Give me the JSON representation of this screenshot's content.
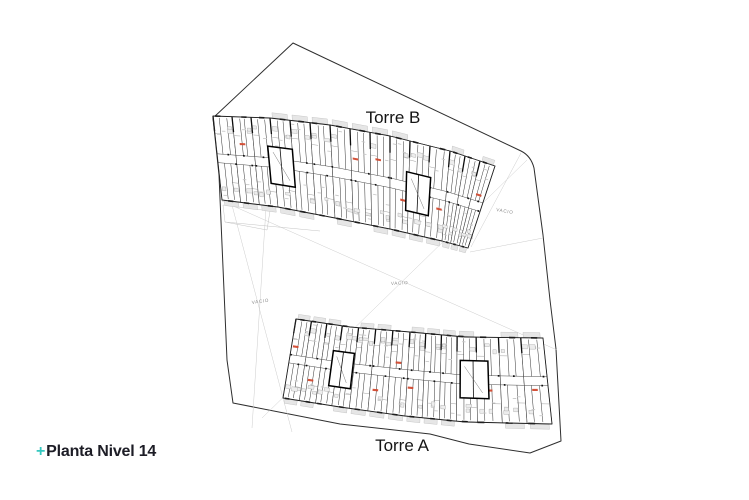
{
  "title_block": {
    "plus": "+",
    "title": "Planta Nivel 14",
    "accent_color": "#35c8c0",
    "text_color": "#1d1d26"
  },
  "plan": {
    "tower_top_label": "Torre B",
    "tower_bottom_label": "Torre A",
    "void_label": "VACIO",
    "colors": {
      "boundary": "#2e2e2e",
      "band_outline": "#222222",
      "wall": "#3c3c3c",
      "wall_light": "#777777",
      "wall_heavy": "#0d0d0d",
      "corridor": "#4a4a4a",
      "furniture_fill": "#ededed",
      "furniture_stroke": "#9a9a9a",
      "balcony_fill": "#e6e6e6",
      "balcony_stroke": "#bdbdbd",
      "text_smudge": "#c9c9c9",
      "unit_tag": "#d2492e",
      "faint_line": "#cccccc",
      "void_text": "#8a8a8a",
      "label_text": "#141414"
    }
  }
}
